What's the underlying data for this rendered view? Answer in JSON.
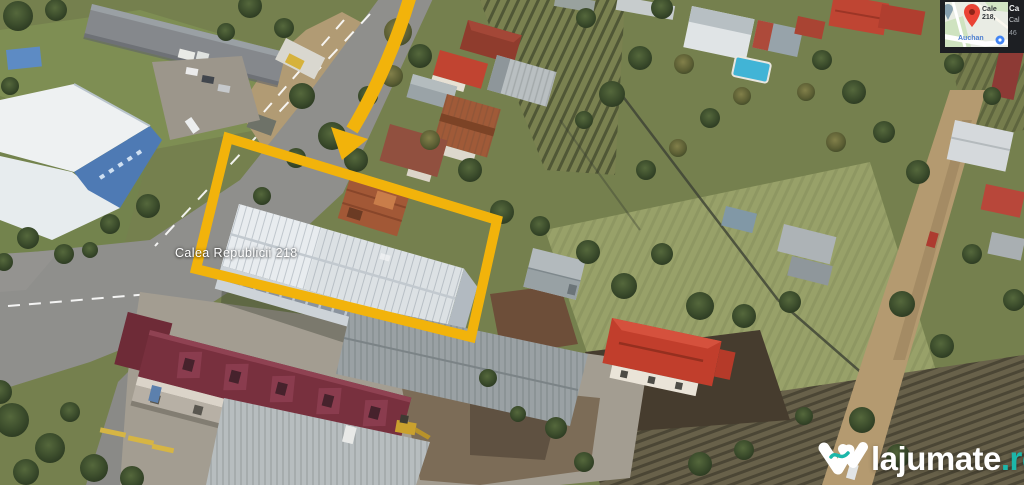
{
  "photo": {
    "street_label": "Calea Republicii 218"
  },
  "map_panel": {
    "minimap": {
      "pin_label_line1": "Cale",
      "pin_label_line2": "218,",
      "poi_label": "Auchan"
    },
    "info_lines": {
      "line1": "Ca",
      "line2": "Cal",
      "line3": "46"
    }
  },
  "watermark": {
    "brand": "lajumate",
    "tld": ".ro"
  },
  "colors": {
    "annotation_yellow": "#F2B30B",
    "watermark_teal": "#1CB7AA",
    "pin_red": "#EA4335",
    "poi_blue": "#4285F4"
  }
}
